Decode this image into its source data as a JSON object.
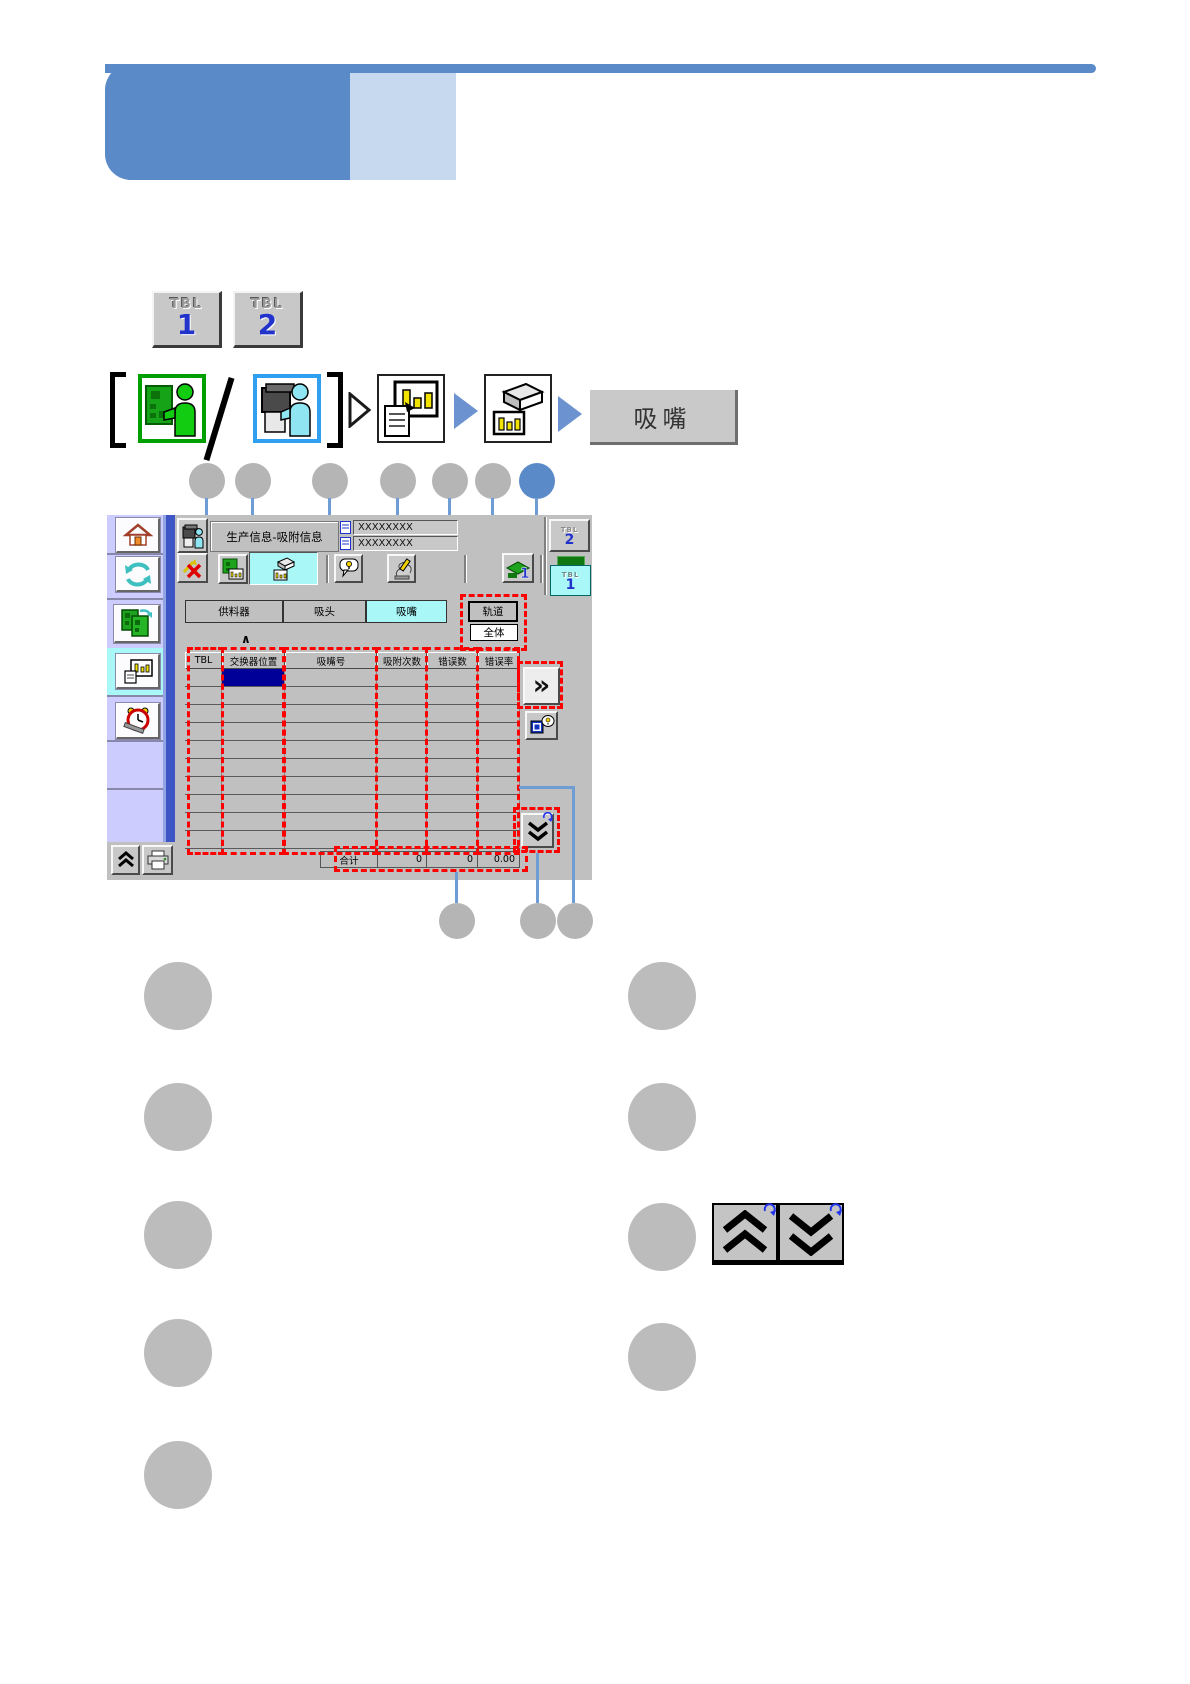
{
  "top_buttons": {
    "tbl1": {
      "label": "TBL",
      "number": "1"
    },
    "tbl2": {
      "label": "TBL",
      "number": "2"
    }
  },
  "flow": {
    "nozzle_label": "吸嘴"
  },
  "ui": {
    "title": "生产信息-吸附信息",
    "fields": {
      "row1": "XXXXXXXX",
      "row2": "XXXXXXXX"
    },
    "side": {
      "tbl2_label": "TBL",
      "tbl2_num": "2",
      "tbl1_label": "TBL",
      "tbl1_num": "1"
    },
    "tabs": {
      "feeder": "供料器",
      "head": "吸头",
      "nozzle": "吸嘴"
    },
    "filters": {
      "track": "轨道",
      "all": "全体"
    },
    "table": {
      "headers": [
        "TBL",
        "交换器位置",
        "吸嘴号",
        "吸附次数",
        "错误数",
        "错误率"
      ],
      "row_count": 10,
      "total": {
        "label": "合计",
        "pickups": "0",
        "errors": "0",
        "rate": "0.00"
      }
    }
  },
  "icons": {
    "chevron_right": "»",
    "caret_up": "∧"
  },
  "colors": {
    "banner_dark": "#5b8ac9",
    "banner_light": "#c6d9ef",
    "leader": "#6e9cd4",
    "callout_gray": "#b5b5b5",
    "callout_blue": "#5b8ac9",
    "selection": "#000099",
    "highlight_cyan": "#a9f7f7",
    "red_dash": "#ff0000",
    "sidebar_lavender": "#ccccff"
  }
}
